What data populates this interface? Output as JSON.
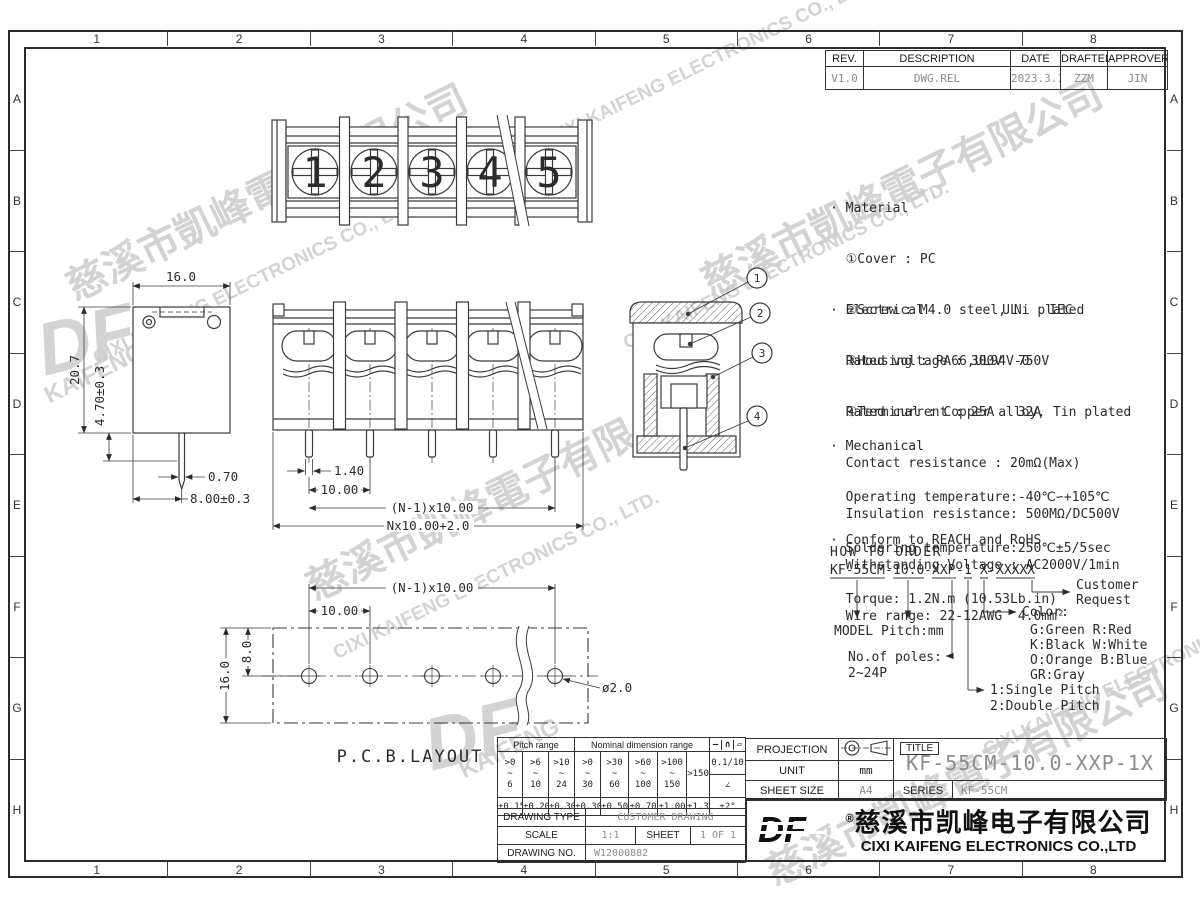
{
  "sheet": {
    "zones": {
      "cols": [
        "1",
        "2",
        "3",
        "4",
        "5",
        "6",
        "7",
        "8"
      ],
      "rows": [
        "A",
        "B",
        "C",
        "D",
        "E",
        "F",
        "G",
        "H"
      ]
    }
  },
  "revision": {
    "headers": {
      "rev": "REV.",
      "description": "DESCRIPTION",
      "date": "DATE",
      "drafter": "DRAFTER",
      "approver": "APPROVER"
    },
    "row": {
      "rev": "V1.0",
      "description": "DWG.REL",
      "date": "2023.3.17",
      "drafter": "ZZM",
      "approver": "JIN"
    }
  },
  "specs": {
    "material": {
      "l0": "· Material",
      "l1": "  ①Cover : PC",
      "l2": "  ②Screw : M4.0 steel, Ni plated",
      "l3": "  ③Housing : PA66,UL94V-0",
      "l4": "  ④Terminal : Copper alloy, Tin plated"
    },
    "electrical": {
      "l0": "· Electrical          UL    IEC",
      "l1": "  Rated voltage : 300V  750V",
      "l2": "  Rated current : 25A   32A",
      "l3": "  Contact resistance : 20mΩ(Max)",
      "l4": "  Insulation resistance: 500MΩ/DC500V",
      "l5": "  Withstanding Voltage : AC2000V/1min",
      "l6": "  Wire range: 22-12AWG  4.0mm²"
    },
    "mechanical": {
      "l0": "· Mechanical",
      "l1": "  Operating temperature:-40℃∽+105℃",
      "l2": "  Soldering temperature:250℃±5/5sec",
      "l3": "  Torque: 1.2N.m (10.53Lb.in)"
    },
    "conform": {
      "l0": "· Conform to REACH and RoHS"
    }
  },
  "order": {
    "heading": "HOW TO ORDER",
    "code": {
      "model": "KF-55CM",
      "sep1": "-",
      "pitch": "10.0",
      "sep2": "-",
      "poles": "XXP",
      "sep3": "-",
      "pitch_type": "1",
      "color": "X",
      "sep5": "-",
      "custom": "XXXXX"
    },
    "labels": {
      "model_pitch": "MODEL  Pitch:mm",
      "poles1": "No.of poles:",
      "poles2": "2~24P",
      "color": "Color:",
      "colors1": "G:Green   R:Red",
      "colors2": "K:Black   W:White",
      "colors3": "O:Orange  B:Blue",
      "colors4": "GR:Gray",
      "pitch1": "1:Single Pitch",
      "pitch2": "2:Double Pitch",
      "customer1": "Customer",
      "customer2": "Request"
    }
  },
  "views": {
    "top": {
      "terminals": [
        "1",
        "2",
        "3",
        "4",
        "5"
      ]
    },
    "side": {
      "dims": {
        "w": "16.0",
        "h": "20.7",
        "pin_len": "4.70±0.3",
        "pin_w": "0.70",
        "pin_x": "8.00±0.3"
      }
    },
    "front": {
      "dims": {
        "pin_w": "1.40",
        "pitch": "10.00",
        "span": "(N-1)x10.00",
        "total": "Nx10.00+2.0"
      }
    },
    "section": {
      "balloons": [
        "1",
        "2",
        "3",
        "4"
      ]
    },
    "pcb": {
      "label": "P.C.B.LAYOUT",
      "dims": {
        "span": "(N-1)x10.00",
        "pitch": "10.00",
        "row": "8.0",
        "height": "16.0",
        "hole": "ø2.0"
      }
    }
  },
  "tolerance": {
    "pitch_header": "Pitch range",
    "nominal_header": "Nominal dimension range",
    "sym1": "—",
    "sym2": "∩",
    "sym3": "▱",
    "r1": ">0\n~\n6",
    "r2": ">6\n~\n10",
    "r3": ">10\n~\n24",
    "r4": ">0\n~\n30",
    "r5": ">30\n~\n60",
    "r6": ">60\n~\n100",
    "r7": ">100\n~\n150",
    "r8": ">150",
    "flat": "0.1/10",
    "angle_sym": "∠",
    "t1": "±0.15",
    "t2": "±0.20",
    "t3": "±0.30",
    "t4": "±0.30",
    "t5": "±0.50",
    "t6": "±0.70",
    "t7": "±1.00",
    "t8": "±1.30",
    "t9": "±2°"
  },
  "titleblock": {
    "projection_label": "PROJECTION",
    "unit_label": "UNIT",
    "unit_value": "mm",
    "sheet_size_label": "SHEET SIZE",
    "sheet_size_value": "A4",
    "series_label": "SERIES",
    "series_value": "KF-55CM",
    "title_label": "TITLE",
    "title_value": "KF-55CM-10.0-XXP-1X"
  },
  "drawingblock": {
    "type_label": "DRAWING TYPE",
    "type_value": "CUSTOMER DRAWING",
    "scale_label": "SCALE",
    "scale_value": "1:1",
    "sheet_label": "SHEET",
    "sheet_value": "1 OF 1",
    "no_label": "DRAWING NO.",
    "no_value": "W12000882"
  },
  "company": {
    "logo": "DF",
    "reg": "®",
    "name_cn": "慈溪市凯峰电子有限公司",
    "name_en": "CIXI KAIFENG ELECTRONICS CO.,LTD"
  },
  "watermark": {
    "cn": "慈溪市凱峰電子有限公司",
    "en": "CIXI KAIFENG ELECTRONICS CO., LTD.",
    "logo": "DF",
    "brand": "KAIFENG"
  }
}
